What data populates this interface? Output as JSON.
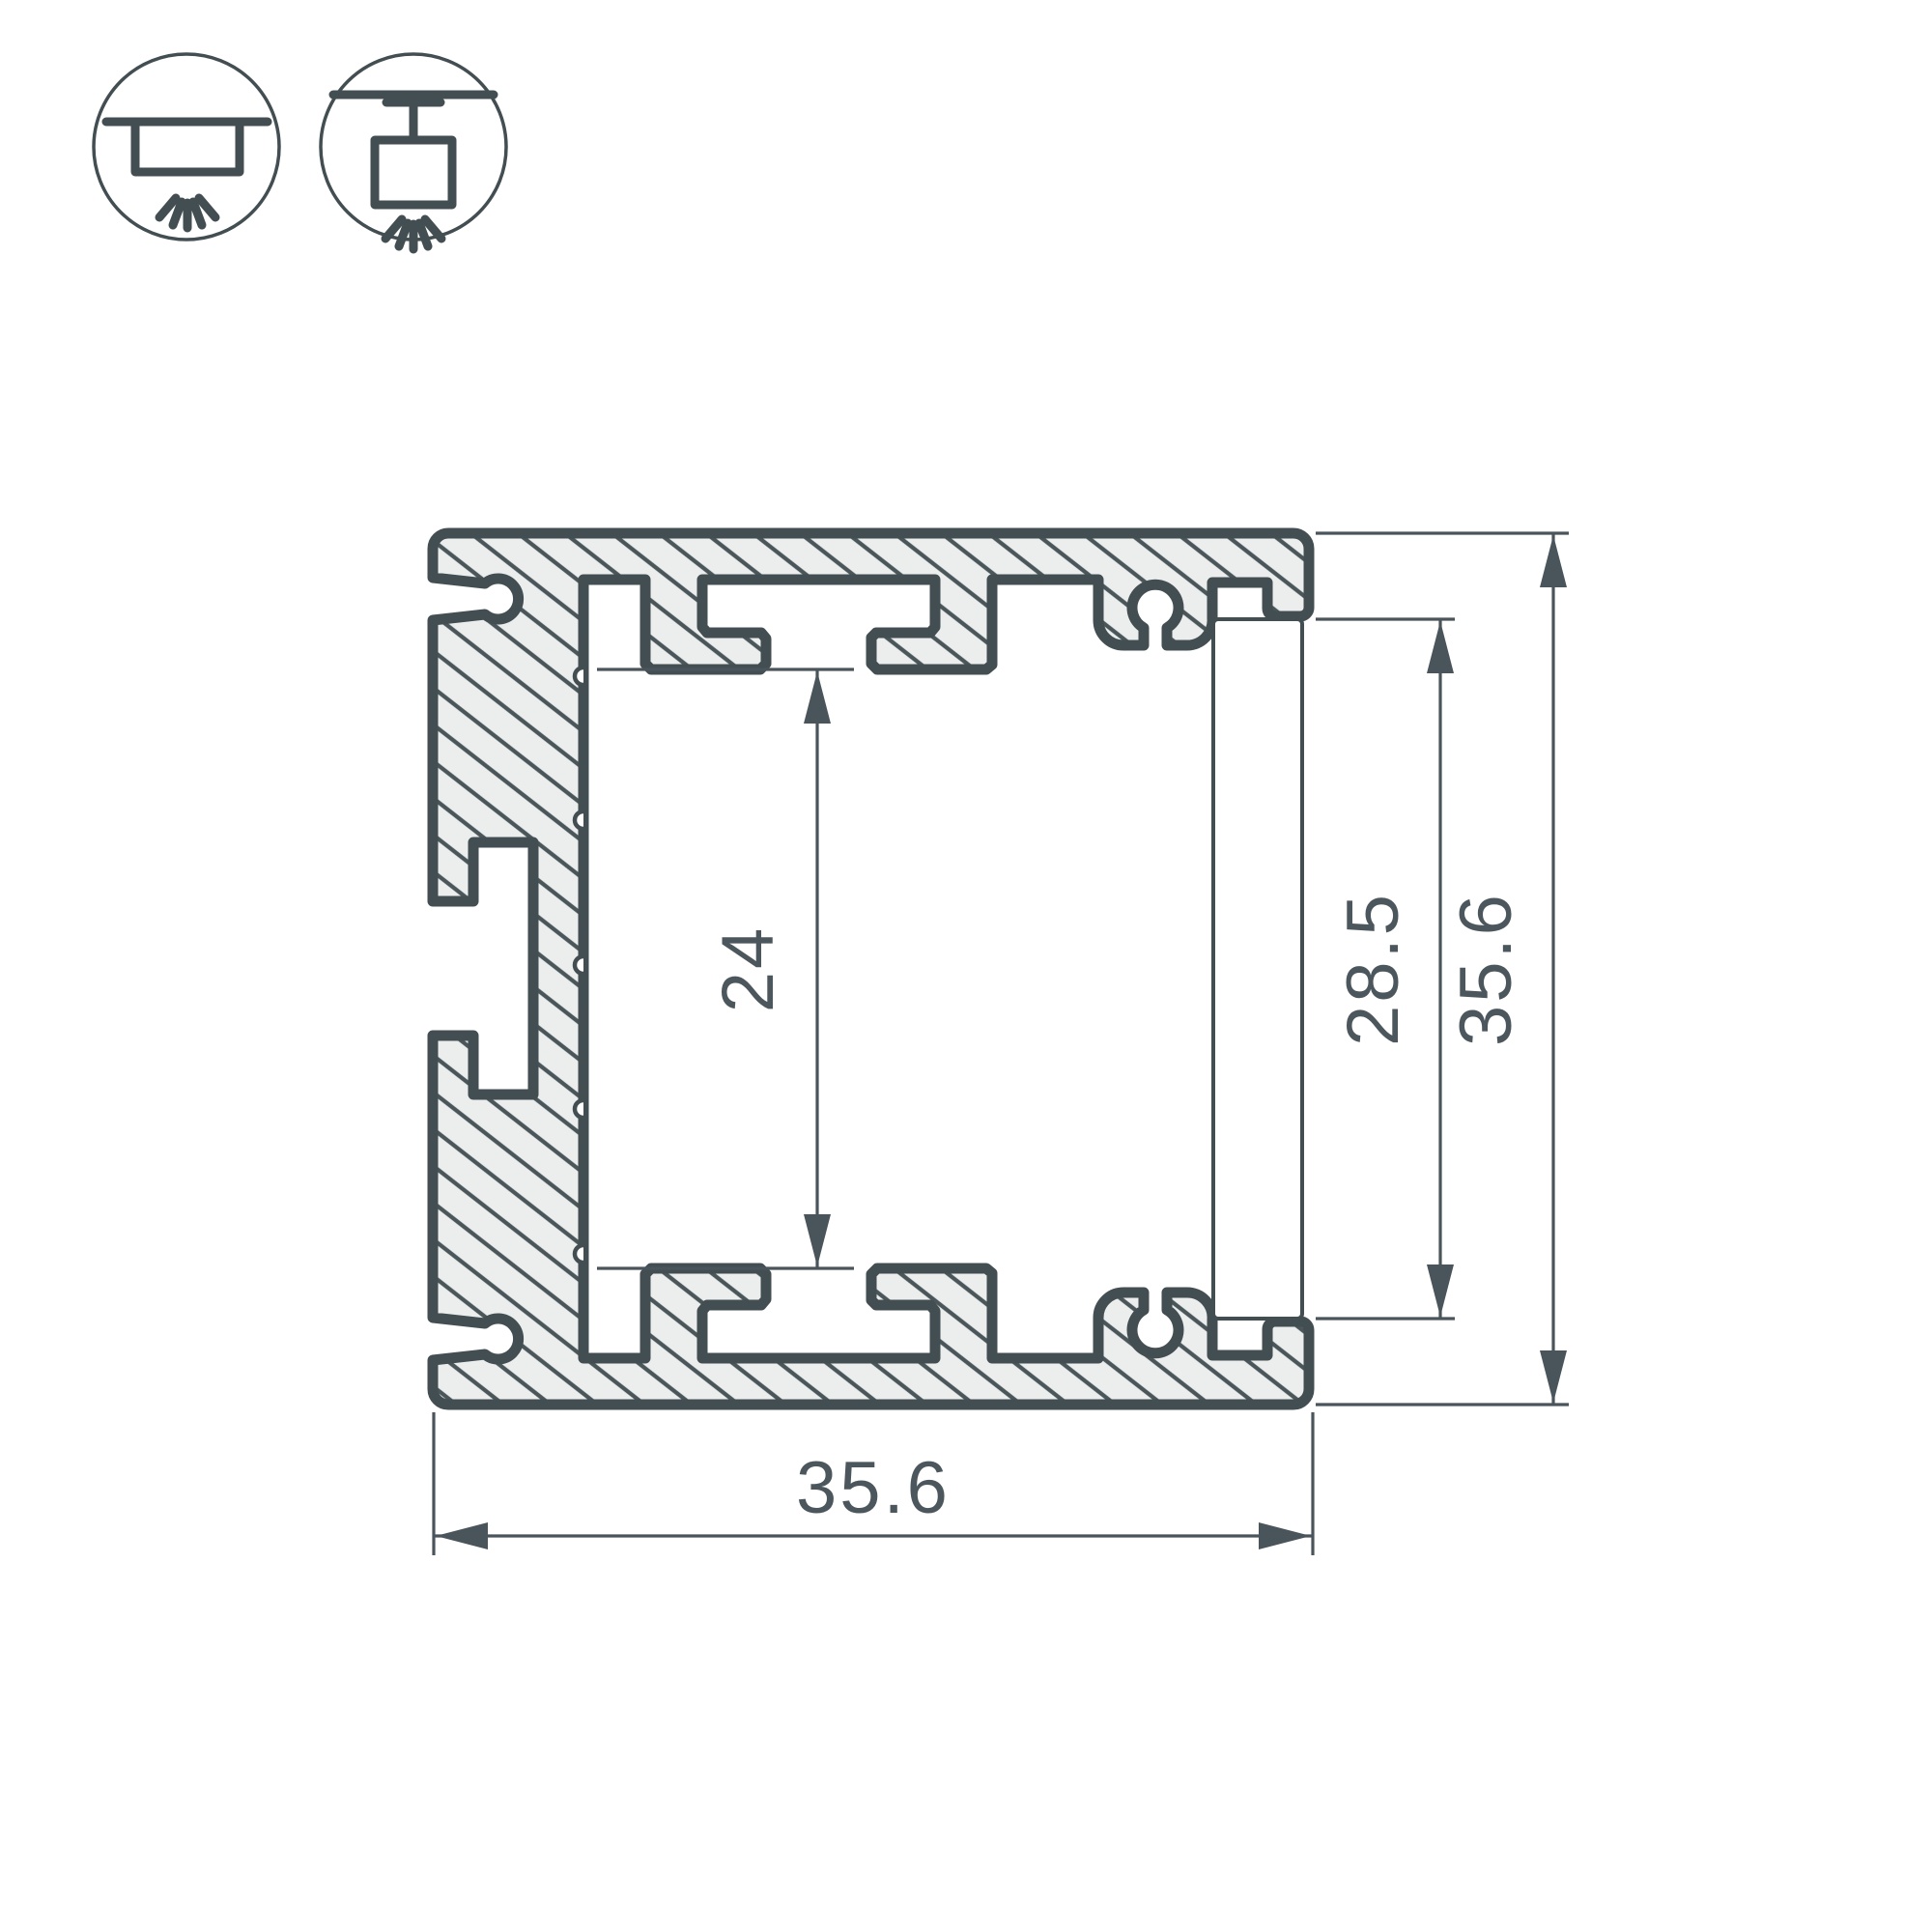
{
  "drawing": {
    "type": "technical-cross-section",
    "subject": "aluminium-led-profile",
    "dimensions": {
      "cavity_height": "24",
      "cover_height": "28.5",
      "overall_height": "35.6",
      "overall_width": "35.6"
    },
    "icons": {
      "surface_mount": "surface-mount-light-icon",
      "pendant_mount": "pendant-mount-light-icon"
    },
    "colors": {
      "outline": "#434E52",
      "hatch": "#4A565A",
      "fill": "#ECEEEE",
      "dimension": "#4A555B",
      "text": "#4C575D",
      "background": "#FFFFFF"
    }
  }
}
